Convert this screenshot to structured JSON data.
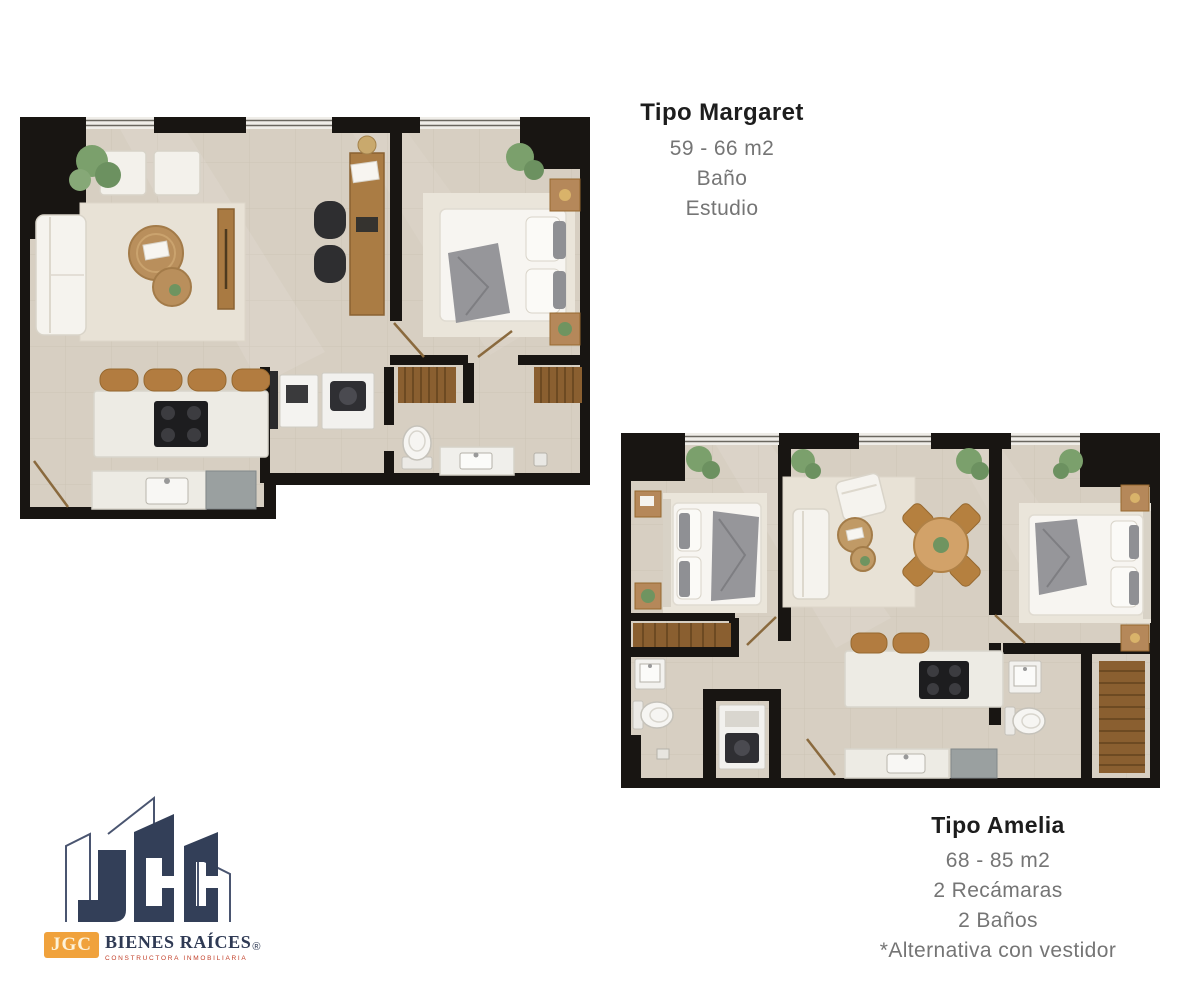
{
  "page": {
    "background": "#ffffff"
  },
  "plans": {
    "margaret": {
      "name": "Tipo Margaret",
      "area": "59 - 66 m2",
      "features": [
        "Baño",
        "Estudio"
      ]
    },
    "amelia": {
      "name": "Tipo Amelia",
      "area": "68 - 85 m2",
      "features": [
        "2 Recámaras",
        "2 Baños",
        "*Alternativa con vestidor"
      ]
    }
  },
  "logo": {
    "acronym": "JGC",
    "name": "BIENES RAÍCES",
    "registered": "®",
    "tagline": "CONSTRUCTORA INMOBILIARIA"
  },
  "palette": {
    "wall": "#181512",
    "floor": "#d7cfc2",
    "wood": "#aa7c44",
    "stool_wood": "#b27c40",
    "closet_wood": "#8a5f30",
    "white_furniture": "#f5f3ee",
    "blanket_gray": "#96969a",
    "plant_green": "#7ba06c",
    "navy": "#333f58",
    "orange": "#f0a23c",
    "red": "#c2402a",
    "text_dark": "#1d1d1d",
    "text_gray": "#757575"
  }
}
